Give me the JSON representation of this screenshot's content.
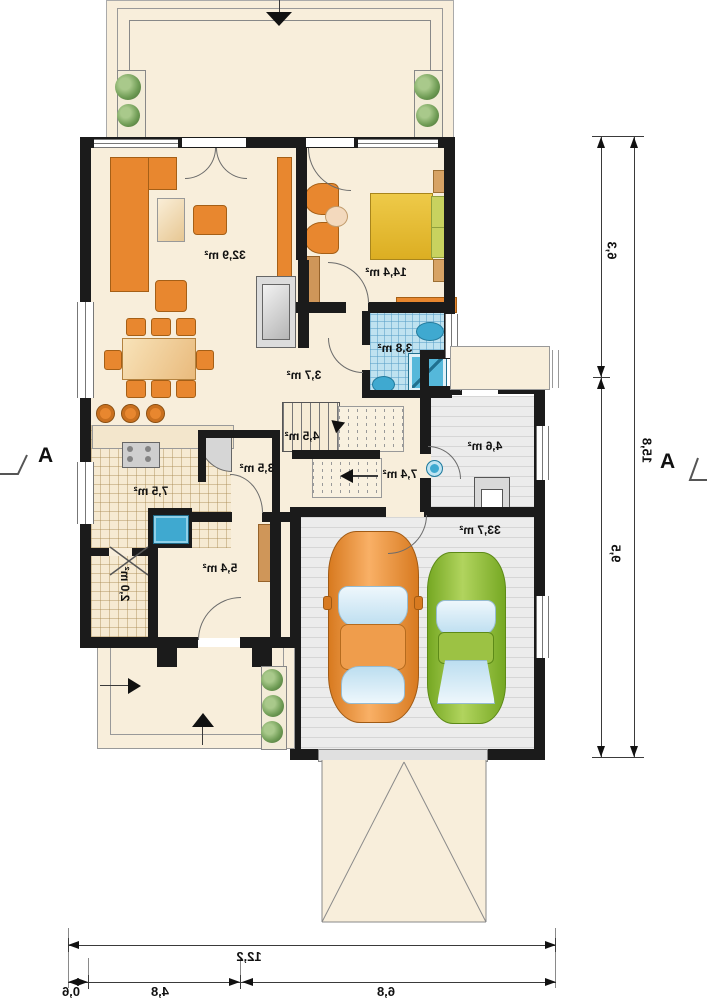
{
  "plan_labels": {
    "living": "32,9 m²",
    "bedroom": "14,4 m²",
    "bathroom": "3,8 m²",
    "hall": "3,7 m²",
    "stairs": "4,5 m²",
    "wardrobe": "3,5 m²",
    "kitchen": "7,5 m²",
    "pantry": "2,0 m²",
    "vestibule": "5,4 m²",
    "corridor": "7,4 m²",
    "utility": "4,6 m²",
    "garage": "33,7 m²"
  },
  "dimensions": {
    "right_segment_top": "6,3",
    "right_segment_bottom": "9,5",
    "right_total": "15,8",
    "bottom_total": "12,2",
    "bottom_segment_left": "0,6",
    "bottom_segment_middle": "4,8",
    "bottom_segment_right": "6,8"
  },
  "section_markers": {
    "left": "A",
    "right": "A"
  },
  "colors": {
    "wall": "#1b1b1b",
    "floor": "#f8eedb",
    "furniture_orange": "#e8872f",
    "bathroom_tile": "#bfe2f0",
    "fixture_blue": "#3fa9d0",
    "garage_gray": "#ececec",
    "car_orange": "#f09340",
    "car_green": "#8fbe33",
    "bed_yellow": "#e9c33b",
    "plant_green": "#6f9c55"
  }
}
